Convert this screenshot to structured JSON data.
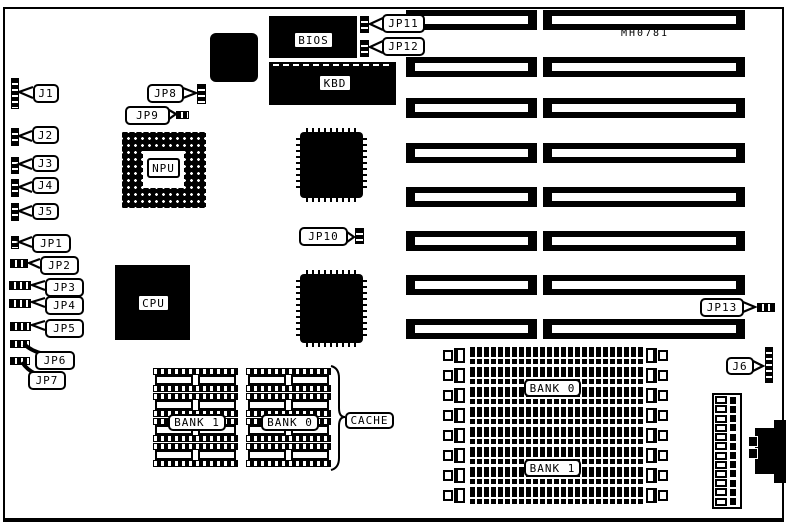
{
  "board": {
    "part_number": "MH0781"
  },
  "labels": {
    "j1": "J1",
    "j2": "J2",
    "j3": "J3",
    "j4": "J4",
    "j5": "J5",
    "j6": "J6",
    "jp1": "JP1",
    "jp2": "JP2",
    "jp3": "JP3",
    "jp4": "JP4",
    "jp5": "JP5",
    "jp6": "JP6",
    "jp7": "JP7",
    "jp8": "JP8",
    "jp9": "JP9",
    "jp10": "JP10",
    "jp11": "JP11",
    "jp12": "JP12",
    "jp13": "JP13",
    "bios": "BIOS",
    "kbd": "KBD",
    "npu": "NPU",
    "cpu": "CPU",
    "cache": "CACHE",
    "cache_bank1": "BANK 1",
    "cache_bank0": "BANK 0",
    "simm_bank0": "BANK 0",
    "simm_bank1": "BANK 1"
  },
  "counts": {
    "isa_slot_rows": 8,
    "isa_slot_columns": 2,
    "simm_sockets": 8,
    "cache_banks": 2,
    "cache_rows_per_bank": 4,
    "power_connector_pins": 12
  }
}
